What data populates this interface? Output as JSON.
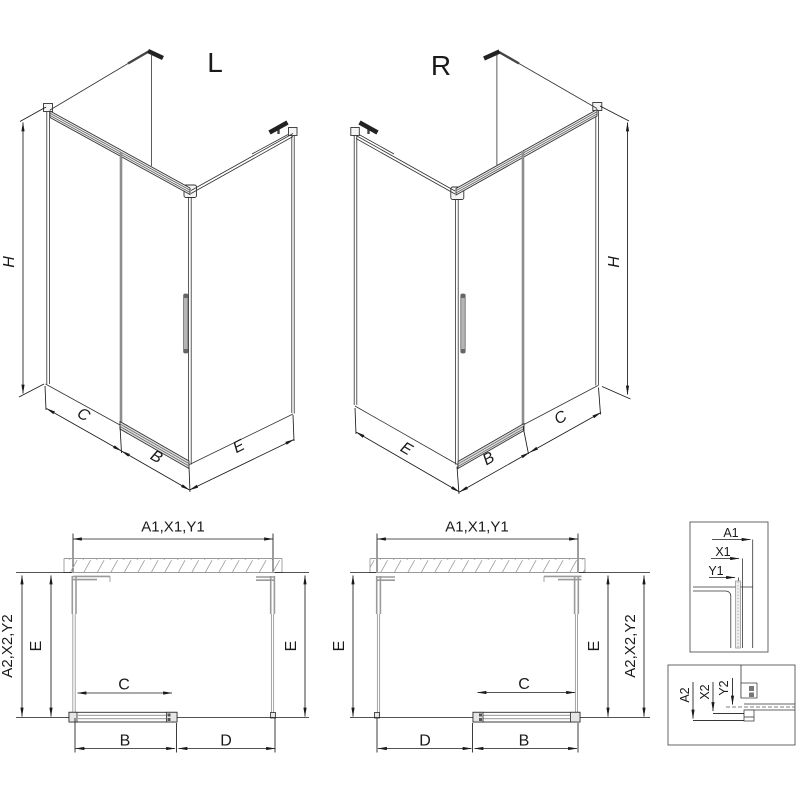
{
  "colors": {
    "line": "#1a1a1a",
    "profile_gray": "#9a9a9a",
    "hatch_gray": "#9a9a9a",
    "glass_gray": "#8e8e8e",
    "background": "#ffffff"
  },
  "iso_l": {
    "label": "L",
    "dim_h": "H",
    "dim_c": "C",
    "dim_b": "B",
    "dim_e": "E"
  },
  "iso_r": {
    "label": "R",
    "dim_h": "H",
    "dim_c": "C",
    "dim_b": "B",
    "dim_e": "E"
  },
  "plan_l": {
    "dim_top": "A1,X1,Y1",
    "dim_left_outer": "A2,X2,Y2",
    "dim_left_inner": "E",
    "dim_right": "E",
    "dim_opening": "C",
    "dim_bottom_left": "B",
    "dim_bottom_right": "D"
  },
  "plan_r": {
    "dim_top": "A1,X1,Y1",
    "dim_left": "E",
    "dim_right_inner": "E",
    "dim_right_outer": "A2,X2,Y2",
    "dim_opening": "C",
    "dim_bottom_left": "D",
    "dim_bottom_right": "B"
  },
  "detail_top": {
    "dim_a": "A1",
    "dim_x": "X1",
    "dim_y": "Y1"
  },
  "detail_bottom": {
    "dim_a": "A2",
    "dim_x": "X2",
    "dim_y": "Y2"
  }
}
